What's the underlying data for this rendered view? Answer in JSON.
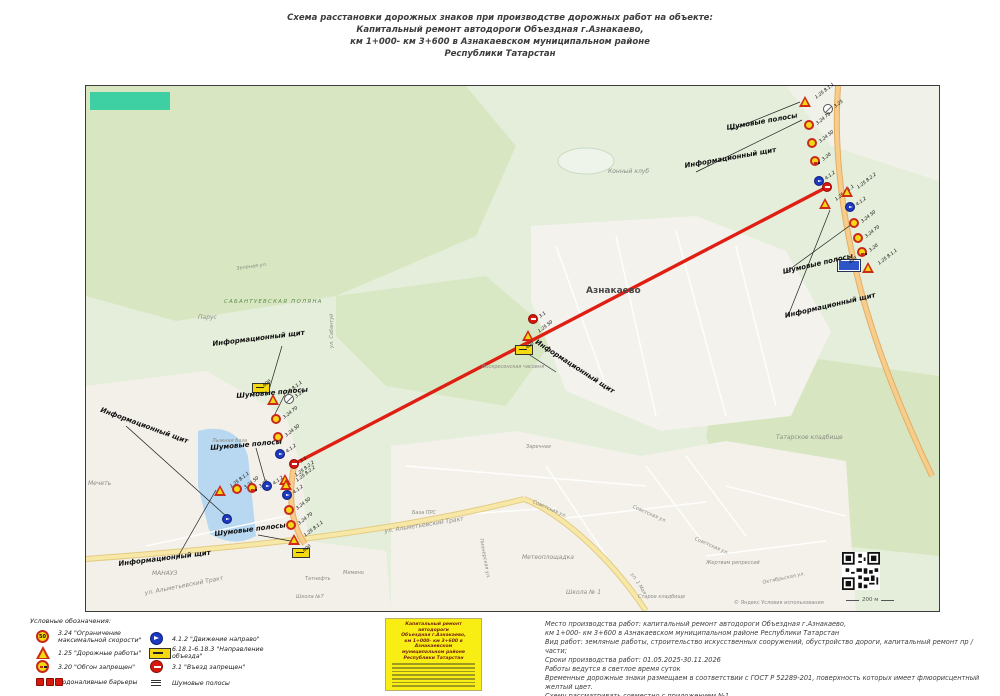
{
  "title": {
    "line1": "Схема расстановки дорожных знаков при производстве дорожных работ на объекте:",
    "line2": "Капитальный ремонт автодороги Объездная г.Азнакаево,",
    "line3": "км 1+000- км 3+600 в Азнакаевском муниципальном районе",
    "line4": "Республики Татарстан"
  },
  "map": {
    "copyright": "© Яндекс  Условия использования",
    "scale_label": "200 м",
    "places": [
      {
        "text": "Конный клуб",
        "x": 522,
        "y": 82
      },
      {
        "text": "Азнакаево",
        "x": 500,
        "y": 200,
        "cls": "city"
      },
      {
        "text": "САБАНТУЕВСКАЯ ПОЛЯНА",
        "x": 138,
        "y": 213,
        "cls": "green"
      },
      {
        "text": "Парус",
        "x": 112,
        "y": 228
      },
      {
        "text": "Зеленая ул.",
        "x": 150,
        "y": 180,
        "rot": -8,
        "cls": "small"
      },
      {
        "text": "ул. Сабантуй",
        "x": 243,
        "y": 262,
        "rot": -90,
        "cls": "small"
      },
      {
        "text": "Воскресенская часовня",
        "x": 396,
        "y": 278,
        "cls": "small"
      },
      {
        "text": "Лыжная база",
        "x": 126,
        "y": 352,
        "cls": "small"
      },
      {
        "text": "Мечеть",
        "x": 2,
        "y": 394
      },
      {
        "text": "МАНАУЗ",
        "x": 66,
        "y": 484
      },
      {
        "text": "Татнефть",
        "x": 219,
        "y": 490,
        "cls": "small"
      },
      {
        "text": "Мимино",
        "x": 257,
        "y": 484,
        "cls": "small"
      },
      {
        "text": "База ПРС",
        "x": 326,
        "y": 424,
        "cls": "small"
      },
      {
        "text": "Школа №7",
        "x": 210,
        "y": 508,
        "cls": "small"
      },
      {
        "text": "Метеоплощадка",
        "x": 436,
        "y": 468
      },
      {
        "text": "Школа № 1",
        "x": 480,
        "y": 503
      },
      {
        "text": "Заречная",
        "x": 440,
        "y": 358,
        "cls": "small"
      },
      {
        "text": "ул. Альметьевский Тракт",
        "x": 298,
        "y": 442,
        "rot": -9
      },
      {
        "text": "ул. Альметьевский Тракт",
        "x": 58,
        "y": 504,
        "rot": -11
      },
      {
        "text": "ул. 1 Мая",
        "x": 548,
        "y": 486,
        "rot": 57,
        "cls": "small"
      },
      {
        "text": "Советская ул.",
        "x": 448,
        "y": 413,
        "rot": 24,
        "cls": "small"
      },
      {
        "text": "Советская ул.",
        "x": 548,
        "y": 418,
        "rot": 24,
        "cls": "small"
      },
      {
        "text": "Советская ул.",
        "x": 610,
        "y": 450,
        "rot": 24,
        "cls": "small"
      },
      {
        "text": "Татарское кладбище",
        "x": 690,
        "y": 348
      },
      {
        "text": "Жертвам репрессий",
        "x": 620,
        "y": 474,
        "cls": "small"
      },
      {
        "text": "Старое кладбище",
        "x": 552,
        "y": 508,
        "cls": "small"
      },
      {
        "text": "Октябрьская ул.",
        "x": 676,
        "y": 494,
        "rot": -12,
        "cls": "small"
      },
      {
        "text": "Пионерская ул.",
        "x": 398,
        "y": 452,
        "rot": 80,
        "cls": "small"
      }
    ],
    "annotations": [
      {
        "text": "Информационный щит",
        "x": 598,
        "y": 76,
        "rot": -10
      },
      {
        "text": "Шумовые полосы",
        "x": 640,
        "y": 38,
        "rot": -10
      },
      {
        "text": "Информационный щит",
        "x": 698,
        "y": 226,
        "rot": -13
      },
      {
        "text": "Шумовые полосы",
        "x": 696,
        "y": 182,
        "rot": -13
      },
      {
        "text": "Информационный щит",
        "x": 126,
        "y": 254,
        "rot": -7
      },
      {
        "text": "Шумовые полосы",
        "x": 150,
        "y": 306,
        "rot": -5
      },
      {
        "text": "Информационный щит",
        "x": 16,
        "y": 320,
        "rot": 20
      },
      {
        "text": "Шумовые полосы",
        "x": 124,
        "y": 358,
        "rot": -5
      },
      {
        "text": "Шумовые полосы",
        "x": 128,
        "y": 444,
        "rot": -7
      },
      {
        "text": "Информационный щит",
        "x": 32,
        "y": 474,
        "rot": -7
      },
      {
        "text": "Информационный щит",
        "x": 452,
        "y": 252,
        "rot": 33
      }
    ],
    "signs": [
      {
        "t": "tri",
        "x": 713,
        "y": 10,
        "label": "1.25 8.1.1"
      },
      {
        "t": "cs",
        "x": 737,
        "y": 18,
        "label": "3.25"
      },
      {
        "t": "cy",
        "x": 718,
        "y": 34,
        "label": "3.24 70"
      },
      {
        "t": "cy",
        "x": 721,
        "y": 52,
        "label": "3.24 50"
      },
      {
        "t": "cy2",
        "x": 724,
        "y": 70,
        "label": "3.20"
      },
      {
        "t": "cb",
        "x": 728,
        "y": 90,
        "label": "4.1.2"
      },
      {
        "t": "tri",
        "x": 733,
        "y": 112,
        "label": "1.25 8.1.1"
      },
      {
        "t": "cr",
        "x": 736,
        "y": 96,
        "label": ""
      },
      {
        "t": "tri",
        "x": 755,
        "y": 100,
        "label": "1.25 8.2.2"
      },
      {
        "t": "cb",
        "x": 759,
        "y": 116,
        "label": "4.1.2"
      },
      {
        "t": "cy",
        "x": 763,
        "y": 132,
        "label": "3.24 50"
      },
      {
        "t": "cy",
        "x": 767,
        "y": 147,
        "label": "3.24 70"
      },
      {
        "t": "cy2",
        "x": 771,
        "y": 161,
        "label": "3.20"
      },
      {
        "t": "tri",
        "x": 776,
        "y": 176,
        "label": "1.25 8.1.1"
      },
      {
        "t": "rb",
        "x": 752,
        "y": 174,
        "label": "400"
      },
      {
        "t": "ry",
        "x": 166,
        "y": 297,
        "label": "600"
      },
      {
        "t": "tri",
        "x": 181,
        "y": 308,
        "label": "1.25 8.1.1"
      },
      {
        "t": "cs",
        "x": 198,
        "y": 308,
        "label": "3.21"
      },
      {
        "t": "cy",
        "x": 185,
        "y": 328,
        "label": "3.24 70"
      },
      {
        "t": "cy",
        "x": 187,
        "y": 346,
        "label": "3.24 50"
      },
      {
        "t": "cb",
        "x": 189,
        "y": 363,
        "label": "4.1.2"
      },
      {
        "t": "cr",
        "x": 203,
        "y": 373,
        "label": "3.1"
      },
      {
        "t": "tri",
        "x": 193,
        "y": 388,
        "label": "1.25 8.2.2"
      },
      {
        "t": "cb",
        "x": 196,
        "y": 404,
        "label": "4.1.2"
      },
      {
        "t": "cy",
        "x": 198,
        "y": 419,
        "label": "3.24 50"
      },
      {
        "t": "cy",
        "x": 200,
        "y": 434,
        "label": "3.24 70"
      },
      {
        "t": "tri",
        "x": 202,
        "y": 448,
        "label": "1.25 8.1.1"
      },
      {
        "t": "ry",
        "x": 206,
        "y": 462,
        "label": "600"
      },
      {
        "t": "tri",
        "x": 128,
        "y": 399,
        "label": "1.25 8.1.1"
      },
      {
        "t": "cy",
        "x": 146,
        "y": 398,
        "label": "3.24 50"
      },
      {
        "t": "cy2",
        "x": 161,
        "y": 397,
        "label": "3.20"
      },
      {
        "t": "cb",
        "x": 176,
        "y": 395,
        "label": "4.1.2"
      },
      {
        "t": "tri",
        "x": 194,
        "y": 393,
        "label": "1.25 8.2.2"
      },
      {
        "t": "cr",
        "x": 442,
        "y": 228,
        "label": "3.1"
      },
      {
        "t": "tri",
        "x": 436,
        "y": 244,
        "label": "1.25 50"
      },
      {
        "t": "ry",
        "x": 429,
        "y": 259,
        "label": "400"
      },
      {
        "t": "cb",
        "x": 136,
        "y": 428,
        "label": ""
      }
    ],
    "leaders": [
      {
        "x1": 645,
        "y1": 44,
        "x2": 714,
        "y2": 16
      },
      {
        "x1": 610,
        "y1": 86,
        "x2": 716,
        "y2": 34
      },
      {
        "x1": 702,
        "y1": 230,
        "x2": 744,
        "y2": 124
      },
      {
        "x1": 700,
        "y1": 186,
        "x2": 766,
        "y2": 138
      },
      {
        "x1": 196,
        "y1": 260,
        "x2": 183,
        "y2": 304
      },
      {
        "x1": 198,
        "y1": 310,
        "x2": 187,
        "y2": 332
      },
      {
        "x1": 40,
        "y1": 340,
        "x2": 140,
        "y2": 430
      },
      {
        "x1": 170,
        "y1": 362,
        "x2": 180,
        "y2": 398
      },
      {
        "x1": 172,
        "y1": 449,
        "x2": 210,
        "y2": 456
      },
      {
        "x1": 90,
        "y1": 474,
        "x2": 130,
        "y2": 404
      },
      {
        "x1": 436,
        "y1": 264,
        "x2": 470,
        "y2": 286
      }
    ]
  },
  "legend": {
    "header": "Условные обозначения:",
    "left": [
      {
        "text": "3.24 \"Ограничение максимальной скорости\""
      },
      {
        "text": "1.25 \"Дорожные работы\""
      },
      {
        "text": "3.20 \"Обгон запрещен\""
      },
      {
        "text": "Водоналивные барьеры"
      }
    ],
    "right": [
      {
        "text": "4.1.2 \"Движение направо\""
      },
      {
        "text": "6.18.1-6.18.3 \"Направление объезда\""
      },
      {
        "text": "3.1 \"Въезд запрещен\""
      },
      {
        "text": "Шумовые полосы"
      }
    ],
    "speed_value": "50"
  },
  "stamp": {
    "line1": "Капитальный ремонт автодороги",
    "line2": "Объездная г.Азнакаево,",
    "line3": "км 1+000- км 3+600 в Азнакаевском",
    "line4": "муниципальном районе",
    "line5": "Республики Татарстан"
  },
  "notes": {
    "lines": [
      "Место производства работ:  капитальный ремонт автодороги Объездная г.Азнакаево,",
      "км 1+000- км 3+600 в Азнакаевском муниципальном районе Республики Татарстан",
      "Вид работ:  земляные работы,  строительство искусственных сооружений,  обустройство дороги,  капитальный ремонт пр / части;",
      "Сроки производства работ: 01.05.2025-30.11.2026",
      "Работы ведутся в светлое время суток",
      "Временные дорожные знаки размещаем в соответствии с ГОСТ Р 52289-201, поверхность которых имеет флюорисцентный желтый цвет.",
      "Схему рассматривать совместно с приложением №1",
      "Ответственный:  начальник дорожного участка:  Ахмадишин Р.М.,  телефон:  +7917-240-83-66"
    ]
  }
}
